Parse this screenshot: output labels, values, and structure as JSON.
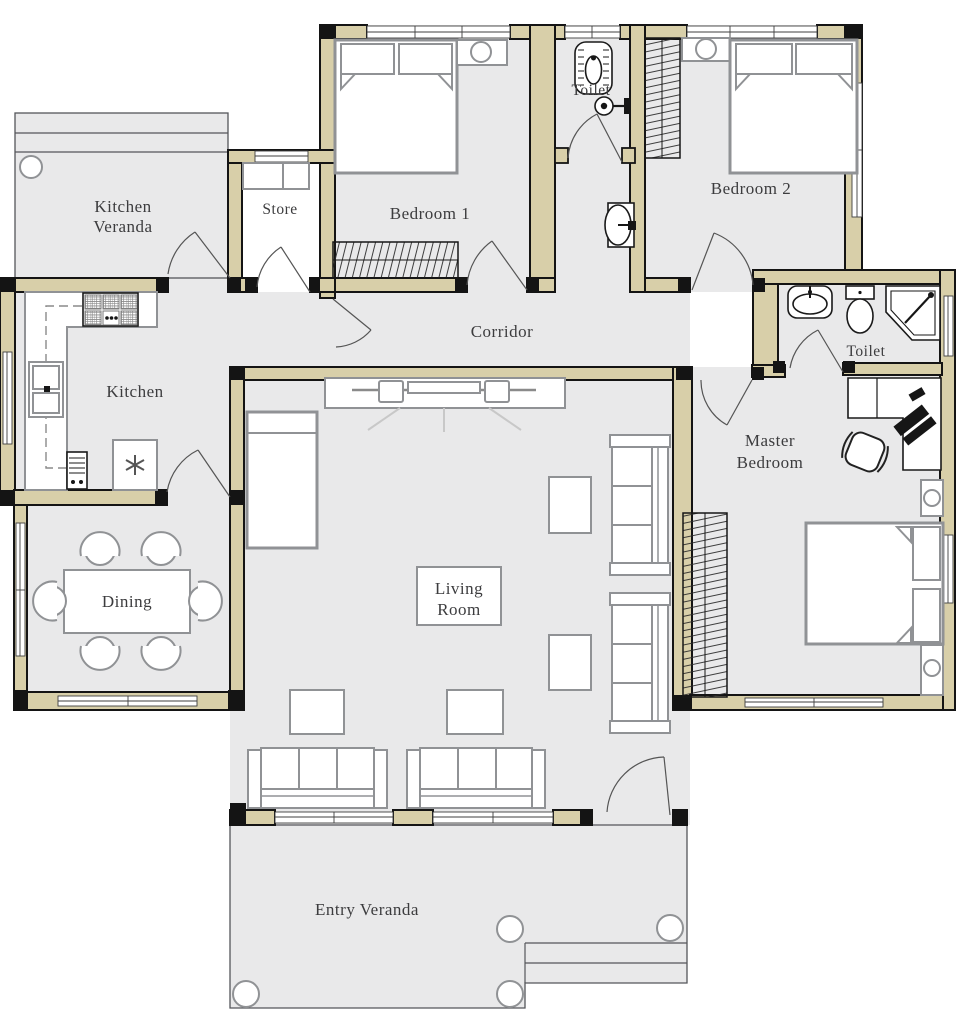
{
  "colors": {
    "wall": "#d8cfa9",
    "floor": "#e9e9ea",
    "outline": "#141414",
    "furn": "#909295",
    "fixture": "#1a1a1a",
    "door": "#555555",
    "label": "#3c3c3e"
  },
  "rooms": {
    "kitchen_veranda": {
      "line1": "Kitchen",
      "line2": "Veranda"
    },
    "store": {
      "label": "Store"
    },
    "bedroom1": {
      "label": "Bedroom 1"
    },
    "toilet1": {
      "label": "Toilet"
    },
    "bedroom2": {
      "label": "Bedroom 2"
    },
    "kitchen": {
      "label": "Kitchen"
    },
    "corridor": {
      "label": "Corridor"
    },
    "toilet2": {
      "label": "Toilet"
    },
    "master_bedroom": {
      "line1": "Master",
      "line2": "Bedroom"
    },
    "dining": {
      "label": "Dining"
    },
    "living_room": {
      "line1": "Living",
      "line2": "Room"
    },
    "entry_veranda": {
      "label": "Entry Veranda"
    }
  },
  "fixtures": [
    "double-bed",
    "pillow",
    "wardrobe",
    "nightstand-lamp",
    "dining-table",
    "dining-chair",
    "sofa-3-seat",
    "side-table",
    "tv-console",
    "tv",
    "speaker",
    "daybed",
    "kitchen-counter",
    "stove",
    "double-sink",
    "water-heater",
    "boiler",
    "squat-toilet",
    "shower-mixer",
    "wash-basin",
    "toilet-wc",
    "corner-shower",
    "desk",
    "laptop",
    "office-chair",
    "column",
    "steps"
  ]
}
